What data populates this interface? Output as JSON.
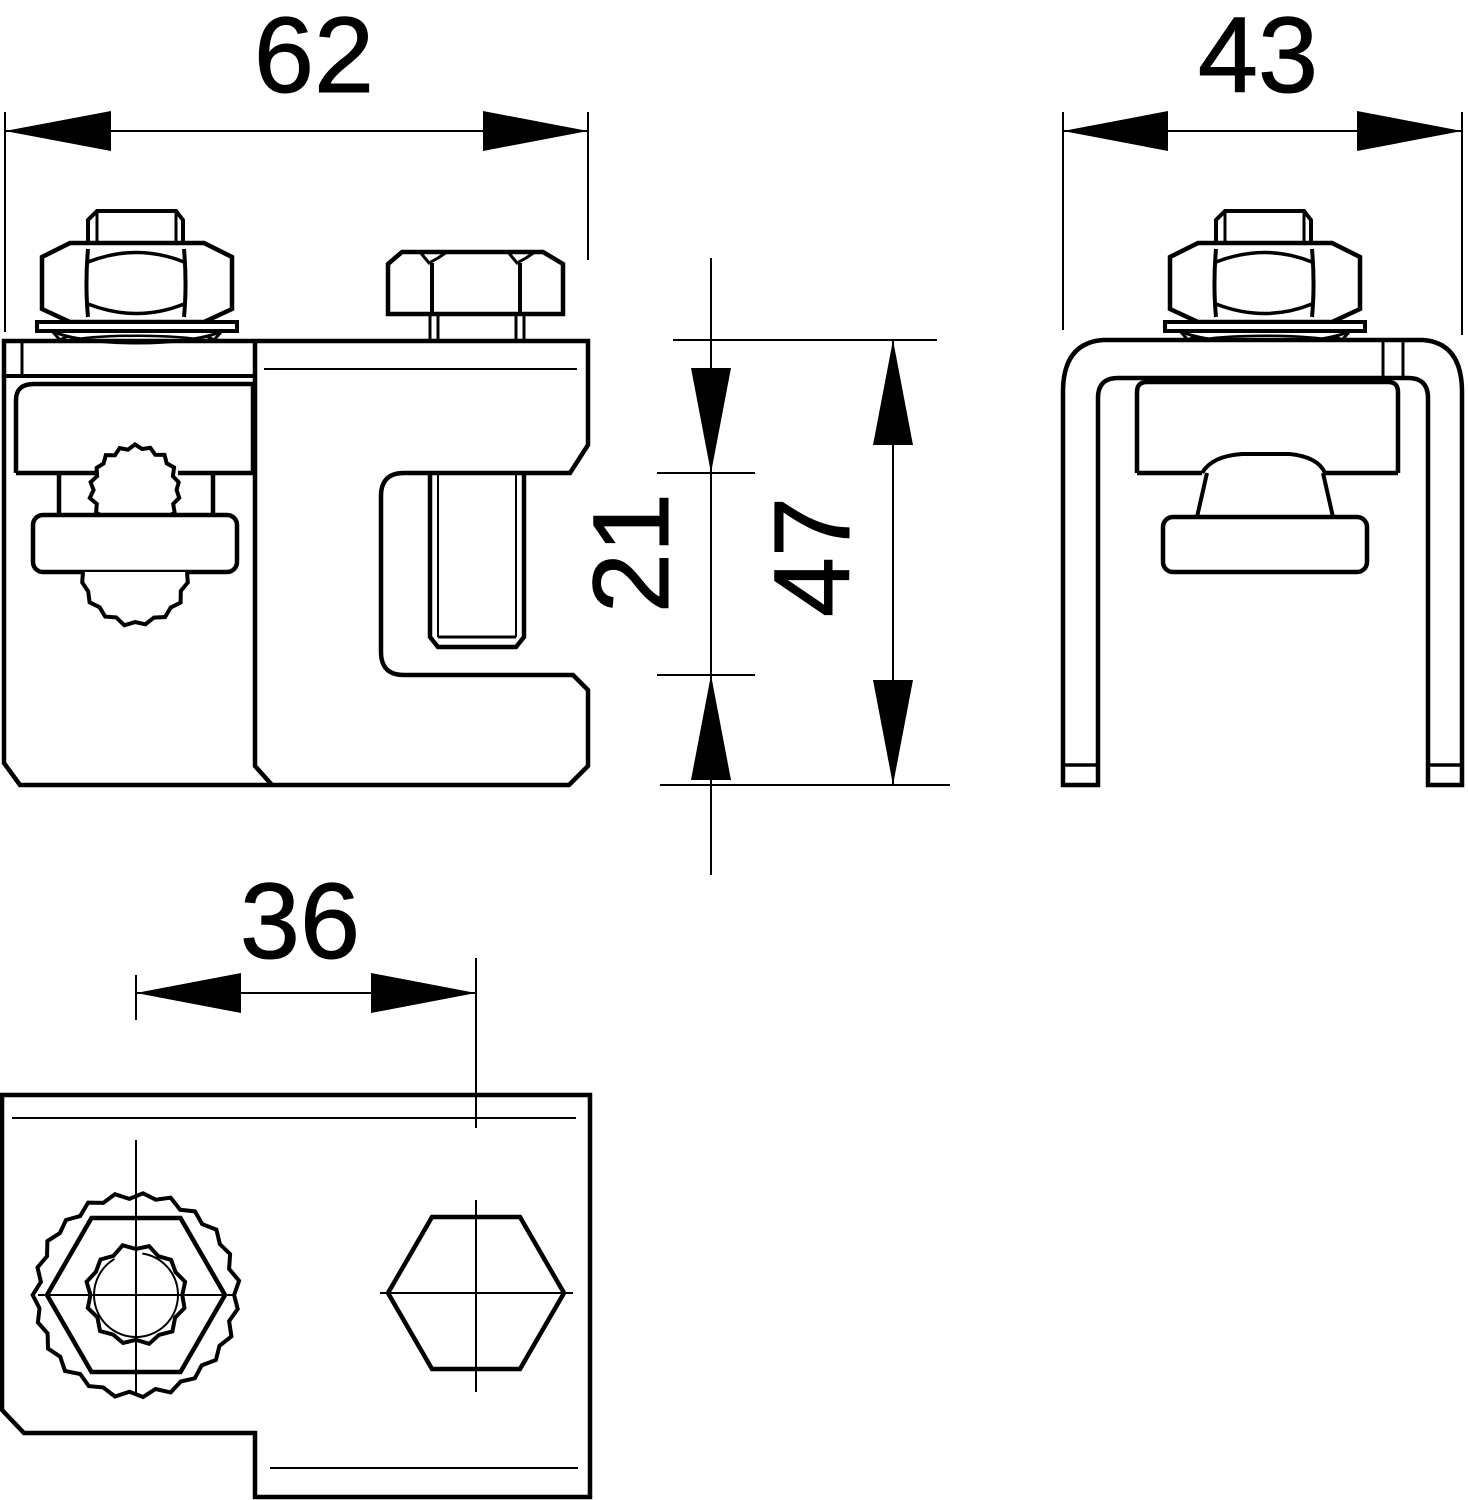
{
  "drawing": {
    "type": "dimensioned technical drawing, three orthographic views of a busbar/conductor clamp",
    "background_color": "#ffffff",
    "line_color": "#000000",
    "dimensions": {
      "front_width": "62",
      "side_width": "43",
      "opening_height": "21",
      "total_height": "47",
      "bolt_spacing": "36"
    }
  }
}
